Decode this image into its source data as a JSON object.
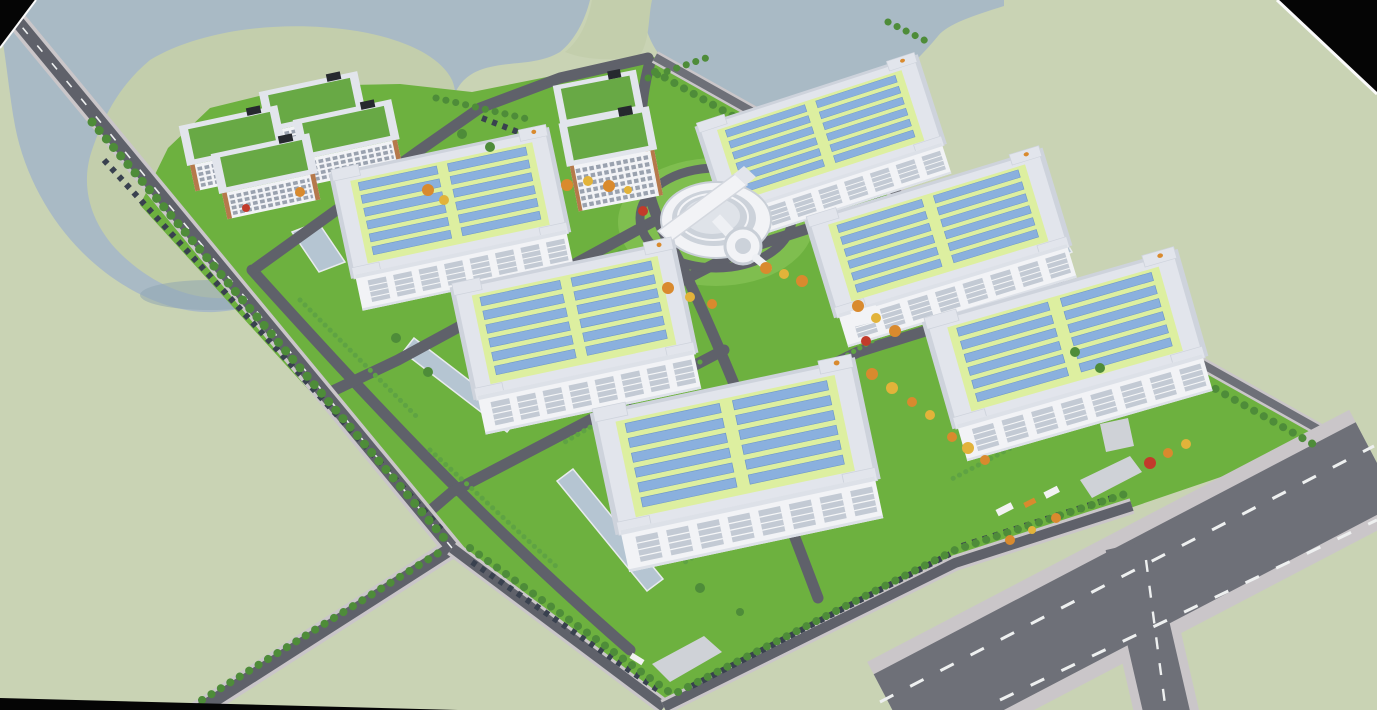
{
  "meta": {
    "title": "Aerial 3D architectural rendering of an industrial park campus",
    "render_type": "bird's-eye perspective masterplan visualization",
    "setting": "campus bordered by a lake to the north-west, open fields, and a public highway to the south-east"
  },
  "colors": {
    "field": "#c9d3b4",
    "island": "#c3ceac",
    "water": "#a9bac5",
    "waterShadow": "#8fa5b3",
    "grass": "#6db13f",
    "grassLight": "#7fbe4f",
    "roadDark": "#5f616a",
    "roadMid": "#6e7078",
    "sidewalk": "#cac6c9",
    "dashWhite": "#eef0f0",
    "roofRim": "#e2e5ec",
    "roofRimDark": "#ced3dc",
    "roofGreen": "#ddefa0",
    "solar": "#8ab0de",
    "solarEdge": "#6d97c9",
    "wall": "#f2f3f6",
    "wallShade": "#dde1e8",
    "windowStrip": "#c3cad4",
    "windowDark": "#9aa2af",
    "officeOrange": "#b5794b",
    "officeRoof": "#68a945",
    "darkBox": "#26292e",
    "pond": "#b5c5d2",
    "pondEdge": "#e8ebee",
    "treeDark": "#4e8c39",
    "hedge": "#5fa343",
    "autumnOrange": "#d98a2e",
    "autumnYellow": "#e2b33a",
    "autumnRed": "#c23b2b",
    "carDark": "#39414f",
    "truckWhite": "#f2f2f2",
    "plaza": "#cfd2d7",
    "circleTop": "#ccd2da",
    "circleInner": "#dfe3e9",
    "black": "#050505"
  },
  "scene": {
    "buildings": [
      {
        "id": "warehouse-1",
        "kind": "solar-roof-warehouse",
        "position": "north-east",
        "roof": "yellow-green field with two banks of blue solar panels"
      },
      {
        "id": "warehouse-2",
        "kind": "solar-roof-warehouse",
        "position": "west"
      },
      {
        "id": "warehouse-3",
        "kind": "solar-roof-warehouse",
        "position": "east"
      },
      {
        "id": "warehouse-4",
        "kind": "solar-roof-warehouse",
        "position": "center"
      },
      {
        "id": "warehouse-5",
        "kind": "solar-roof-warehouse",
        "position": "south-east"
      },
      {
        "id": "warehouse-6",
        "kind": "solar-roof-warehouse",
        "position": "south-center"
      },
      {
        "id": "office-block-1",
        "kind": "green-roof-office",
        "position": "north-west-cluster"
      },
      {
        "id": "office-block-2",
        "kind": "green-roof-office",
        "position": "north-west-cluster"
      },
      {
        "id": "office-block-3",
        "kind": "green-roof-office",
        "position": "north-west-cluster"
      },
      {
        "id": "office-block-4",
        "kind": "green-roof-office",
        "position": "north-west-cluster"
      },
      {
        "id": "office-tower-1",
        "kind": "green-roof-tower",
        "position": "north-center"
      },
      {
        "id": "office-tower-2",
        "kind": "green-roof-tower",
        "position": "north-center"
      },
      {
        "id": "circular-building",
        "kind": "round-exhibition-center with diagonal roof bar and drum annex",
        "position": "campus-center"
      }
    ],
    "water_bodies": [
      "north-west-lake",
      "lake-east-arm",
      "reflecting-pond-1",
      "reflecting-pond-2",
      "reflecting-pond-3",
      "reflecting-pond-4"
    ],
    "roads": [
      "west-perimeter-road",
      "south-access-road",
      "south-perimeter-road",
      "southeast-perimeter-road",
      "northeast-perimeter-road",
      "public-highway",
      "highway-branch",
      "campus-loop-roads",
      "roundabout-ring"
    ],
    "vehicles": {
      "parked_car_rows": 5,
      "trucks": 3,
      "shuttle_bus": 1
    },
    "vegetation": {
      "street_tree_rows": 8,
      "hedge_rows": 7,
      "autumn_trees": "orange, yellow and red accent trees near the center and south-east gate",
      "lawns": "bright green lawns inside campus"
    },
    "frame": "render is slightly rotated leaving black wedges in the top-left, top-right and bottom-left corners"
  }
}
